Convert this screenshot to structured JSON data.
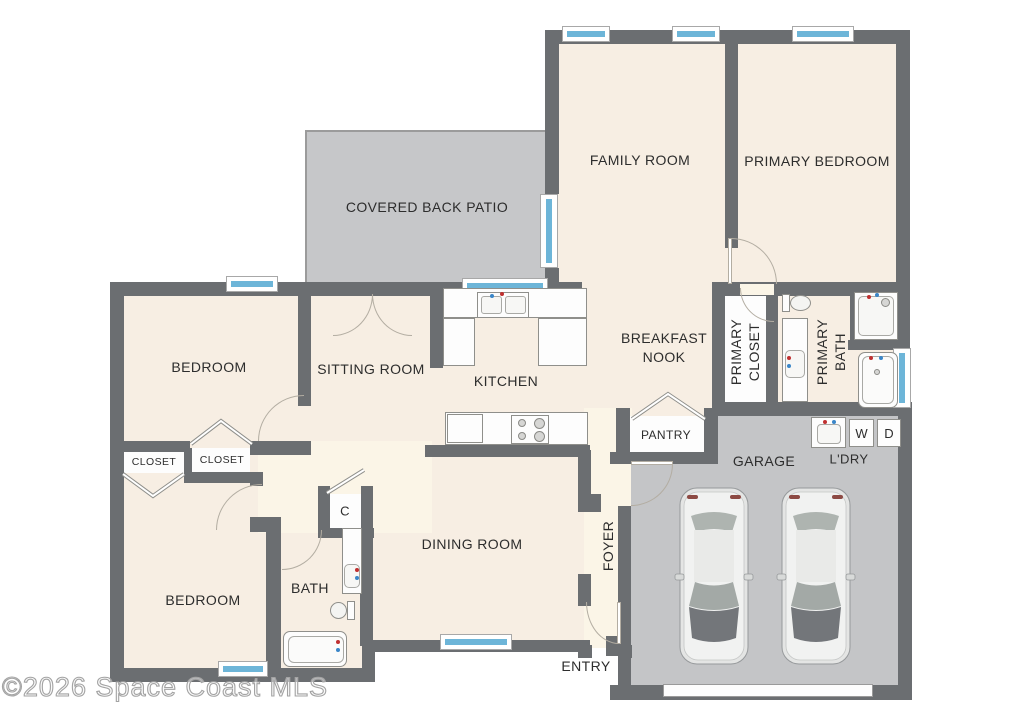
{
  "watermark": "©2026 Space Coast MLS",
  "colors": {
    "wall": "#6b6e71",
    "floor": "#f7eee3",
    "floor_light": "#fbf5e7",
    "patio": "#c6c7c9",
    "garage": "#c4c5c7",
    "window": "#6db5d8",
    "fixture": "#fdfdfd",
    "line": "#b3ada2",
    "label": "#2d2d2d"
  },
  "rooms": {
    "family_room": "FAMILY ROOM",
    "primary_bedroom": "PRIMARY BEDROOM",
    "covered_back_patio": "COVERED BACK PATIO",
    "bedroom_upper": "BEDROOM",
    "sitting_room": "SITTING ROOM",
    "kitchen": "KITCHEN",
    "breakfast_nook": "BREAKFAST NOOK",
    "primary_closet": "PRIMARY CLOSET",
    "primary_bath": "PRIMARY BATH",
    "pantry": "PANTRY",
    "garage": "GARAGE",
    "laundry": "L'DRY",
    "washer": "W",
    "dryer": "D",
    "closet_left": "CLOSET",
    "closet_right": "CLOSET",
    "bedroom_lower": "BEDROOM",
    "bath": "BATH",
    "closet_c": "C",
    "dining_room": "DINING ROOM",
    "foyer": "FOYER",
    "entry": "ENTRY"
  }
}
